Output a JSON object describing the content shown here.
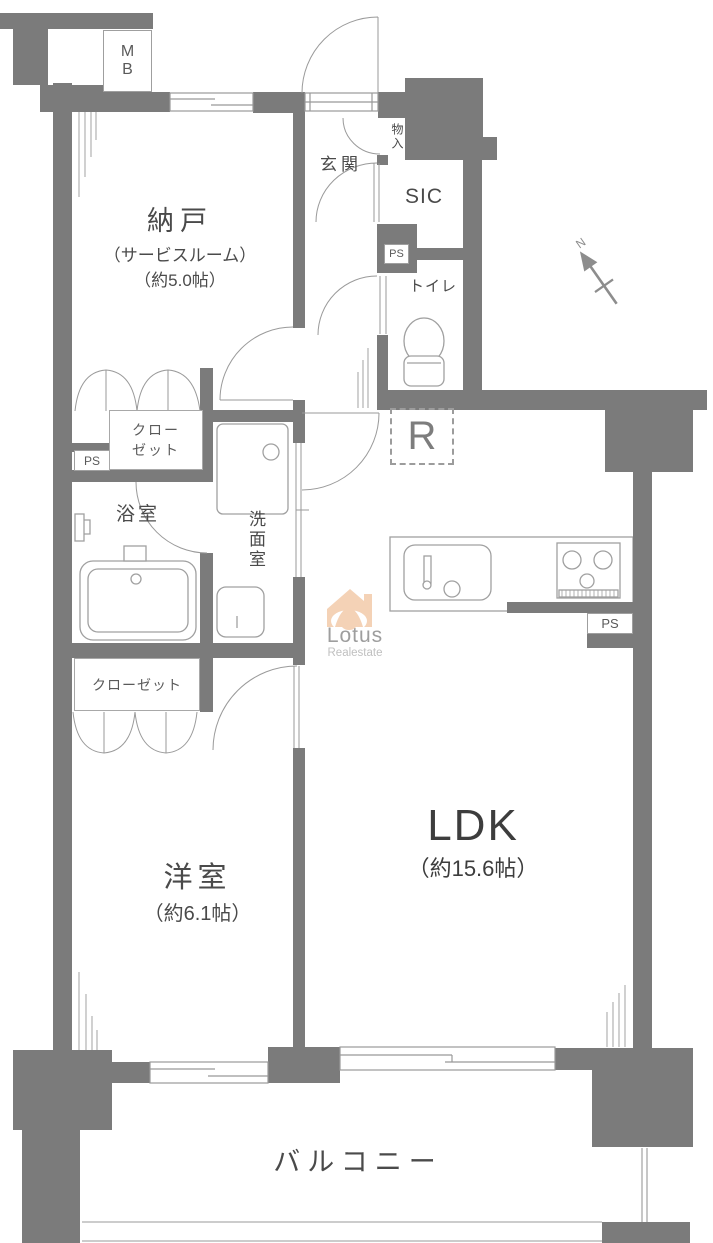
{
  "plan": {
    "rooms": {
      "nando": {
        "name": "納戸",
        "alias": "（サービスルーム）",
        "size": "（約5.0帖）"
      },
      "genkan": {
        "name": "玄関"
      },
      "monoire": {
        "name": "物入"
      },
      "sic": {
        "name": "SIC"
      },
      "toilet": {
        "name": "トイレ"
      },
      "bath": {
        "name": "浴室"
      },
      "senmenshitsu": {
        "name": "洗面室"
      },
      "closet_upper": {
        "line1": "クロー",
        "line2": "ゼット"
      },
      "closet_lower": {
        "name": "クローゼット"
      },
      "youshitsu": {
        "name": "洋室",
        "size": "（約6.1帖）"
      },
      "ldk": {
        "name": "LDK",
        "size": "（約15.6帖）"
      },
      "balcony": {
        "name": "バルコニー"
      }
    },
    "utility": {
      "mb_line1": "M",
      "mb_line2": "B",
      "ps": "PS",
      "refrigerator": "R"
    },
    "compass": {
      "label": "N"
    },
    "watermark": {
      "brand": "Lotus",
      "suffix": "Realestate"
    },
    "colors": {
      "wall": "#7b7b7b",
      "line": "#999999",
      "text": "#4a4a4a",
      "fixture": "#a0a0a0",
      "watermark_logo": "#f2c7a4"
    }
  }
}
